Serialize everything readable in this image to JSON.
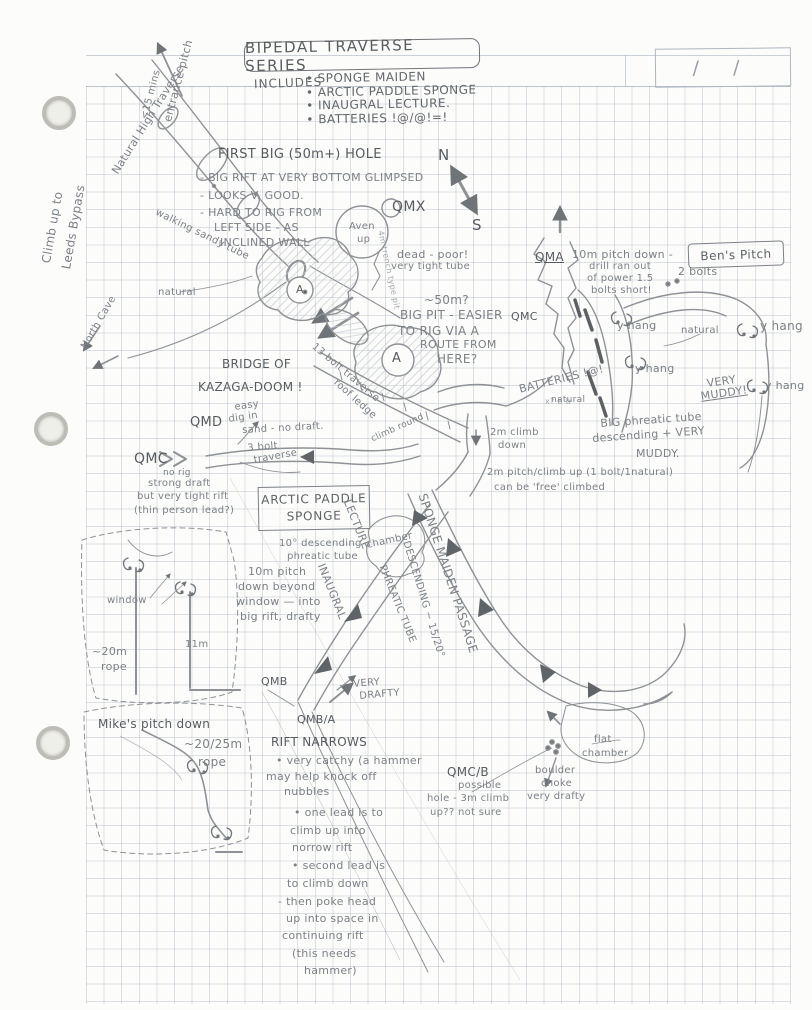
{
  "palette": {
    "pencil": "#7b8187",
    "pencil_dark": "#565b60",
    "grid": "#c2cad4",
    "paper": "#fcfcfa"
  },
  "page": {
    "title": "BIPEDAL TRAVERSE SERIES",
    "date_slashes": "/    /",
    "includes": {
      "label": "INCLUDES",
      "items": [
        "• SPONGE MAIDEN",
        "• ARCTIC PADDLE SPONGE",
        "• INAUGRAL LECTURE.",
        "• BATTERIES !@/@!=!"
      ]
    }
  },
  "boxes": {
    "arctic_line1": "ARCTIC PADDLE",
    "arctic_line2": "SPONGE",
    "bens": "Ben's Pitch"
  },
  "labels": [
    {
      "id": "entrance-pitch",
      "text": "entrance pitch",
      "x": 162,
      "y": 120,
      "rot": -75,
      "fs": 11
    },
    {
      "id": "entrance-time",
      "text": "<15 mins",
      "x": 140,
      "y": 118,
      "rot": -75,
      "fs": 10
    },
    {
      "id": "natural-high-traverse",
      "text": "Natural High Traverse",
      "x": 110,
      "y": 170,
      "rot": -58,
      "fs": 11
    },
    {
      "id": "climb-leeds-1",
      "text": "Climb up to",
      "x": 40,
      "y": 262,
      "rot": -80,
      "fs": 12
    },
    {
      "id": "climb-leeds-2",
      "text": "Leeds Bypass",
      "x": 60,
      "y": 268,
      "rot": -80,
      "fs": 12
    },
    {
      "id": "walking-sandy-tube",
      "text": "walking sandy tube",
      "x": 158,
      "y": 208,
      "rot": 26,
      "fs": 10
    },
    {
      "id": "north-cave",
      "text": "North Cave",
      "x": 80,
      "y": 346,
      "rot": -60,
      "fs": 10
    },
    {
      "id": "natural-a",
      "text": "natural",
      "x": 158,
      "y": 288,
      "fs": 10
    },
    {
      "id": "fbh-title",
      "text": "FIRST BIG (50m+) HOLE",
      "x": 218,
      "y": 148,
      "fs": 13,
      "cls": "dark"
    },
    {
      "id": "fbh-1",
      "text": "- BIG RIFT AT VERY BOTTOM GLIMPSED",
      "x": 200,
      "y": 172,
      "fs": 11
    },
    {
      "id": "fbh-2",
      "text": "- LOOKS V. GOOD.",
      "x": 200,
      "y": 190,
      "fs": 11
    },
    {
      "id": "fbh-3",
      "text": "- HARD TO RIG FROM",
      "x": 200,
      "y": 207,
      "fs": 11
    },
    {
      "id": "fbh-4",
      "text": "LEFT SIDE - AS",
      "x": 214,
      "y": 222,
      "fs": 11
    },
    {
      "id": "fbh-5",
      "text": "INCLINED WALL",
      "x": 220,
      "y": 237,
      "fs": 11
    },
    {
      "id": "trench-pit",
      "text": "4m trench type pit",
      "x": 384,
      "y": 230,
      "rot": 78,
      "fs": 8,
      "cls": "light"
    },
    {
      "id": "qmx",
      "text": "QMX",
      "x": 392,
      "y": 200,
      "fs": 14,
      "cls": "dark"
    },
    {
      "id": "n-mark",
      "text": "N",
      "x": 438,
      "y": 148,
      "fs": 15,
      "cls": "dark"
    },
    {
      "id": "s-mark",
      "text": "S",
      "x": 472,
      "y": 218,
      "fs": 15,
      "cls": "dark"
    },
    {
      "id": "aven-1",
      "text": "Aven",
      "x": 349,
      "y": 222,
      "fs": 10
    },
    {
      "id": "aven-2",
      "text": "up",
      "x": 357,
      "y": 235,
      "fs": 10
    },
    {
      "id": "st-a1",
      "text": "A",
      "x": 296,
      "y": 284,
      "fs": 11,
      "cls": "dark"
    },
    {
      "id": "st-a2",
      "text": "A",
      "x": 392,
      "y": 352,
      "fs": 13,
      "cls": "dark"
    },
    {
      "id": "dead-poor",
      "text": "dead - poor!",
      "x": 397,
      "y": 249,
      "fs": 11
    },
    {
      "id": "tight-tube",
      "text": "very tight tube",
      "x": 391,
      "y": 262,
      "fs": 10
    },
    {
      "id": "fifty-m",
      "text": "~50m?",
      "x": 424,
      "y": 294,
      "fs": 12
    },
    {
      "id": "big-pit-1",
      "text": "BIG PIT - EASIER",
      "x": 400,
      "y": 309,
      "fs": 12
    },
    {
      "id": "big-pit-2",
      "text": "TO RIG VIA A",
      "x": 398,
      "y": 325,
      "fs": 12
    },
    {
      "id": "big-pit-3",
      "text": "ROUTE FROM",
      "x": 420,
      "y": 339,
      "fs": 11
    },
    {
      "id": "big-pit-4",
      "text": "HERE?",
      "x": 437,
      "y": 353,
      "fs": 12
    },
    {
      "id": "qma",
      "text": "QMA",
      "x": 535,
      "y": 251,
      "fs": 12,
      "cls": "dark u"
    },
    {
      "id": "qma-1",
      "text": "10m pitch down -",
      "x": 572,
      "y": 249,
      "fs": 11
    },
    {
      "id": "qma-2",
      "text": "drill ran out",
      "x": 589,
      "y": 262,
      "fs": 10
    },
    {
      "id": "qma-3",
      "text": "of power 1.5",
      "x": 587,
      "y": 274,
      "fs": 10
    },
    {
      "id": "qma-4",
      "text": "bolts short!",
      "x": 591,
      "y": 286,
      "fs": 10
    },
    {
      "id": "qmc-r",
      "text": "QMC",
      "x": 511,
      "y": 311,
      "fs": 11,
      "cls": "dark"
    },
    {
      "id": "bens-2bolts",
      "text": "2 bolts",
      "x": 678,
      "y": 266,
      "fs": 11
    },
    {
      "id": "yhang-1",
      "text": "y hang",
      "x": 617,
      "y": 320,
      "fs": 11
    },
    {
      "id": "natural-b",
      "text": "natural",
      "x": 681,
      "y": 326,
      "fs": 10
    },
    {
      "id": "yhang-2",
      "text": "y hang",
      "x": 760,
      "y": 320,
      "fs": 12
    },
    {
      "id": "yhang-3",
      "text": "y hang",
      "x": 635,
      "y": 363,
      "fs": 11
    },
    {
      "id": "very-muddy-1",
      "text": "VERY",
      "x": 706,
      "y": 378,
      "rot": -8,
      "fs": 11
    },
    {
      "id": "very-muddy-2",
      "text": "MUDDY!",
      "x": 700,
      "y": 391,
      "rot": -8,
      "fs": 11,
      "cls": "u"
    },
    {
      "id": "yhang-4",
      "text": "y hang",
      "x": 765,
      "y": 380,
      "fs": 11
    },
    {
      "id": "batteries-rot",
      "text": "BATTERIES !@!",
      "x": 518,
      "y": 384,
      "rot": -14,
      "fs": 11
    },
    {
      "id": "bolt-bb",
      "text": "x?  b  b",
      "x": 545,
      "y": 398,
      "fs": 8,
      "cls": "light"
    },
    {
      "id": "bridge-1",
      "text": "BRIDGE OF",
      "x": 222,
      "y": 358,
      "fs": 12,
      "cls": "dark"
    },
    {
      "id": "bridge-2",
      "text": "KAZAGA-DOOM !",
      "x": 198,
      "y": 381,
      "fs": 12,
      "cls": "dark"
    },
    {
      "id": "bolt-traverse",
      "text": "13 bolt traverse",
      "x": 316,
      "y": 342,
      "rot": 40,
      "fs": 10
    },
    {
      "id": "roof-ledge",
      "text": "roof ledge",
      "x": 338,
      "y": 378,
      "rot": 42,
      "fs": 10
    },
    {
      "id": "natural-c",
      "text": "natural",
      "x": 551,
      "y": 396,
      "fs": 9
    },
    {
      "id": "big-phreatic-1",
      "text": "BIG phreatic tube",
      "x": 600,
      "y": 418,
      "rot": -4,
      "fs": 11
    },
    {
      "id": "big-phreatic-2",
      "text": "descending + VERY",
      "x": 592,
      "y": 433,
      "rot": -4,
      "fs": 11
    },
    {
      "id": "big-phreatic-3",
      "text": "MUDDY.",
      "x": 636,
      "y": 448,
      "fs": 11
    },
    {
      "id": "qmd",
      "text": "QMD",
      "x": 190,
      "y": 416,
      "fs": 13,
      "cls": "dark"
    },
    {
      "id": "qmd-1",
      "text": "easy",
      "x": 234,
      "y": 403,
      "rot": -8,
      "fs": 10
    },
    {
      "id": "qmd-2",
      "text": "dig in",
      "x": 228,
      "y": 415,
      "rot": -8,
      "fs": 10
    },
    {
      "id": "qmd-3",
      "text": "sand - no draft.",
      "x": 242,
      "y": 426,
      "rot": -3,
      "fs": 10
    },
    {
      "id": "qmc-l",
      "text": "QMC",
      "x": 134,
      "y": 452,
      "fs": 14,
      "cls": "dark"
    },
    {
      "id": "qmcl-1",
      "text": "no rig",
      "x": 163,
      "y": 469,
      "fs": 9
    },
    {
      "id": "qmcl-2",
      "text": "strong draft",
      "x": 148,
      "y": 479,
      "fs": 10
    },
    {
      "id": "qmcl-3",
      "text": "but very tight rift",
      "x": 137,
      "y": 492,
      "fs": 10
    },
    {
      "id": "qmcl-4",
      "text": "(thin person lead?)",
      "x": 134,
      "y": 506,
      "fs": 10
    },
    {
      "id": "bolt3-1",
      "text": "3 bolt",
      "x": 247,
      "y": 444,
      "rot": -5,
      "fs": 10
    },
    {
      "id": "bolt3-2",
      "text": "traverse",
      "x": 253,
      "y": 456,
      "rot": -10,
      "fs": 10
    },
    {
      "id": "climb-round",
      "text": "climb round",
      "x": 370,
      "y": 436,
      "rot": -24,
      "fs": 9
    },
    {
      "id": "climb2m-1",
      "text": "2m climb",
      "x": 490,
      "y": 428,
      "fs": 10
    },
    {
      "id": "climb2m-2",
      "text": "down",
      "x": 498,
      "y": 441,
      "fs": 10
    },
    {
      "id": "pitch2m-1",
      "text": "2m pitch/climb up  (1 bolt/1natural)",
      "x": 487,
      "y": 468,
      "fs": 10
    },
    {
      "id": "pitch2m-2",
      "text": "can be 'free' climbed",
      "x": 494,
      "y": 483,
      "fs": 10
    },
    {
      "id": "tendeg-1",
      "text": "10° descending",
      "x": 279,
      "y": 539,
      "fs": 10
    },
    {
      "id": "tendeg-2",
      "text": "phreatic tube",
      "x": 287,
      "y": 552,
      "fs": 10
    },
    {
      "id": "lecture-rot",
      "text": "LECTURE",
      "x": 352,
      "y": 498,
      "rot": 68,
      "fs": 11
    },
    {
      "id": "inaugural-rot",
      "text": "INAUGRAL",
      "x": 326,
      "y": 562,
      "rot": 68,
      "fs": 11
    },
    {
      "id": "chamber",
      "text": "chamber",
      "x": 366,
      "y": 541,
      "rot": -12,
      "fs": 10
    },
    {
      "id": "sponge-maiden-rot",
      "text": "SPONGE MAIDEN PASSAGE",
      "x": 428,
      "y": 492,
      "rot": 72,
      "fs": 12
    },
    {
      "id": "descending-rot",
      "text": "DESCENDING ~ 15/20°",
      "x": 410,
      "y": 540,
      "rot": 73,
      "fs": 10
    },
    {
      "id": "phreatic-rot",
      "text": "PHREATIC TUBE",
      "x": 386,
      "y": 564,
      "rot": 68,
      "fs": 10
    },
    {
      "id": "pitch10-1",
      "text": "10m pitch",
      "x": 248,
      "y": 566,
      "fs": 11
    },
    {
      "id": "pitch10-2",
      "text": "down beyond",
      "x": 238,
      "y": 581,
      "fs": 11
    },
    {
      "id": "pitch10-3",
      "text": "window — into",
      "x": 236,
      "y": 596,
      "fs": 11
    },
    {
      "id": "pitch10-4",
      "text": "big rift, drafty",
      "x": 240,
      "y": 611,
      "fs": 11
    },
    {
      "id": "window",
      "text": "window",
      "x": 107,
      "y": 596,
      "fs": 10
    },
    {
      "id": "rope20-1",
      "text": "~20m",
      "x": 92,
      "y": 646,
      "fs": 11
    },
    {
      "id": "rope20-2",
      "text": "rope",
      "x": 101,
      "y": 661,
      "fs": 11
    },
    {
      "id": "eleven-m",
      "text": "11m",
      "x": 185,
      "y": 640,
      "fs": 10
    },
    {
      "id": "qmb",
      "text": "QMB",
      "x": 261,
      "y": 676,
      "fs": 11,
      "cls": "dark"
    },
    {
      "id": "very-drafty-1",
      "text": "VERY",
      "x": 353,
      "y": 680,
      "rot": -5,
      "fs": 10
    },
    {
      "id": "very-drafty-2",
      "text": "DRAFTY",
      "x": 359,
      "y": 692,
      "rot": -5,
      "fs": 10
    },
    {
      "id": "qmba",
      "text": "QMB/A",
      "x": 297,
      "y": 714,
      "fs": 11,
      "cls": "dark"
    },
    {
      "id": "rift-narrows",
      "text": "RIFT NARROWS",
      "x": 271,
      "y": 736,
      "fs": 12,
      "cls": "dark"
    },
    {
      "id": "rn-1",
      "text": "• very catchy (a hammer",
      "x": 276,
      "y": 755,
      "fs": 11
    },
    {
      "id": "rn-2",
      "text": "may help knock off",
      "x": 266,
      "y": 771,
      "fs": 11
    },
    {
      "id": "rn-3",
      "text": "nubbles",
      "x": 284,
      "y": 786,
      "fs": 11
    },
    {
      "id": "rn-4",
      "text": "• one lead is to",
      "x": 294,
      "y": 807,
      "fs": 11
    },
    {
      "id": "rn-5",
      "text": "climb up into",
      "x": 290,
      "y": 825,
      "fs": 11
    },
    {
      "id": "rn-6",
      "text": "norrow rift",
      "x": 292,
      "y": 842,
      "fs": 11
    },
    {
      "id": "rn-7",
      "text": "• second lead is",
      "x": 292,
      "y": 860,
      "fs": 11
    },
    {
      "id": "rn-8",
      "text": "to climb down",
      "x": 287,
      "y": 878,
      "fs": 11
    },
    {
      "id": "rn-9",
      "text": "- then poke head",
      "x": 278,
      "y": 896,
      "fs": 11
    },
    {
      "id": "rn-10",
      "text": "up into space in",
      "x": 286,
      "y": 913,
      "fs": 11
    },
    {
      "id": "rn-11",
      "text": "continuing rift",
      "x": 282,
      "y": 930,
      "fs": 11
    },
    {
      "id": "rn-12",
      "text": "(this needs",
      "x": 292,
      "y": 948,
      "fs": 11
    },
    {
      "id": "rn-13",
      "text": "hammer)",
      "x": 304,
      "y": 965,
      "fs": 11
    },
    {
      "id": "mikes-1",
      "text": "Mike's pitch down",
      "x": 98,
      "y": 718,
      "fs": 12,
      "cls": "dark"
    },
    {
      "id": "mikes-2",
      "text": "~20/25m",
      "x": 184,
      "y": 738,
      "fs": 12
    },
    {
      "id": "mikes-3",
      "text": "rope",
      "x": 198,
      "y": 756,
      "fs": 12
    },
    {
      "id": "qmcb-1",
      "text": "QMC/B",
      "x": 447,
      "y": 766,
      "fs": 12,
      "cls": "dark"
    },
    {
      "id": "qmcb-2",
      "text": "possible",
      "x": 458,
      "y": 781,
      "fs": 10
    },
    {
      "id": "qmcb-3",
      "text": "hole - 3m climb",
      "x": 427,
      "y": 794,
      "fs": 10
    },
    {
      "id": "qmcb-4",
      "text": "up?? not sure",
      "x": 430,
      "y": 808,
      "fs": 10
    },
    {
      "id": "boulder-1",
      "text": "boulder",
      "x": 535,
      "y": 766,
      "fs": 10
    },
    {
      "id": "boulder-2",
      "text": "choke",
      "x": 541,
      "y": 779,
      "fs": 10
    },
    {
      "id": "boulder-3",
      "text": "very drafty",
      "x": 527,
      "y": 792,
      "fs": 10
    },
    {
      "id": "flat-1",
      "text": "flat",
      "x": 594,
      "y": 735,
      "fs": 10
    },
    {
      "id": "flat-2",
      "text": "chamber",
      "x": 582,
      "y": 749,
      "fs": 10
    }
  ]
}
